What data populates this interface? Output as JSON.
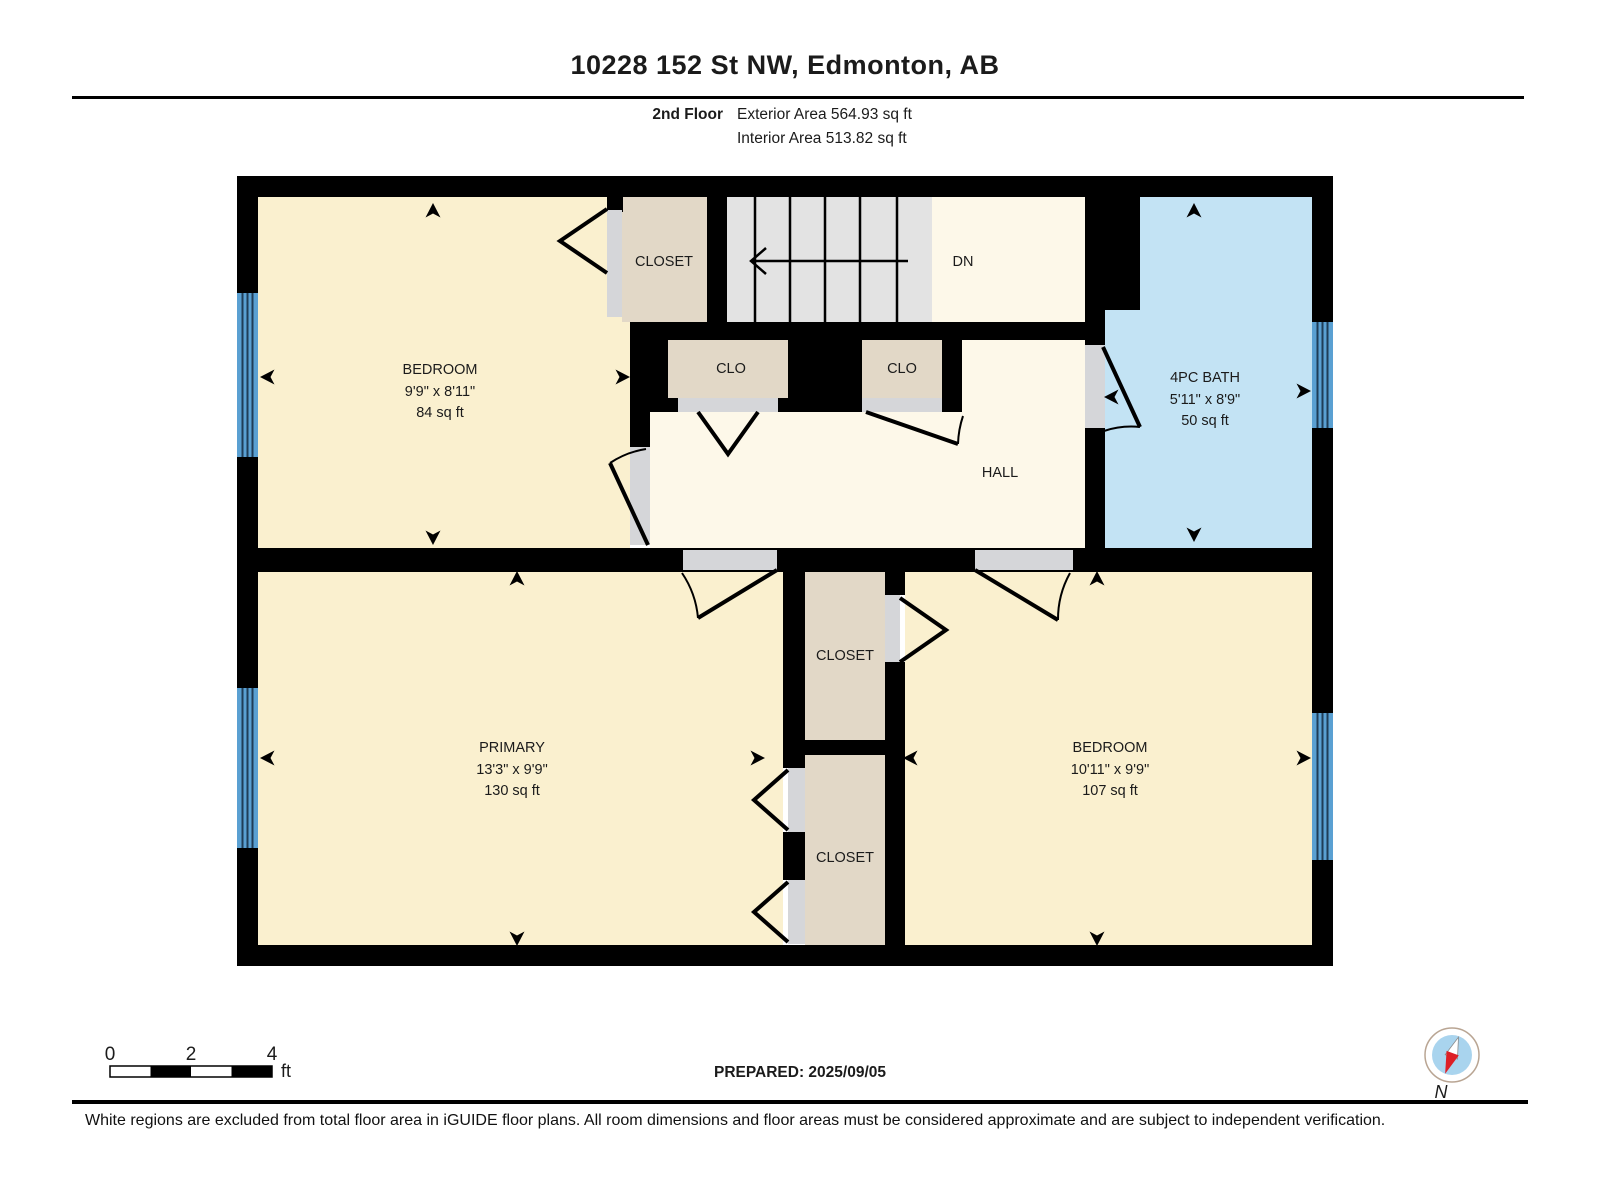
{
  "header": {
    "title": "10228 152 St NW, Edmonton, AB",
    "floor_label": "2nd Floor",
    "exterior_area": "Exterior Area 564.93 sq ft",
    "interior_area": "Interior Area 513.82 sq ft"
  },
  "rooms": {
    "bedroom_top_left": {
      "name": "BEDROOM",
      "dimensions": "9'9\" x 8'11\"",
      "area": "84 sq ft"
    },
    "closet_top": {
      "name": "CLOSET"
    },
    "stairs": {
      "direction_label": "DN"
    },
    "clo_left": {
      "name": "CLO"
    },
    "clo_right": {
      "name": "CLO"
    },
    "bath": {
      "name": "4PC BATH",
      "dimensions": "5'11\" x 8'9\"",
      "area": "50 sq ft"
    },
    "hall": {
      "name": "HALL"
    },
    "primary": {
      "name": "PRIMARY",
      "dimensions": "13'3\" x 9'9\"",
      "area": "130 sq ft"
    },
    "closet_mid": {
      "name": "CLOSET"
    },
    "closet_bottom": {
      "name": "CLOSET"
    },
    "bedroom_bottom_right": {
      "name": "BEDROOM",
      "dimensions": "10'11\" x 9'9\"",
      "area": "107 sq ft"
    }
  },
  "scale_bar": {
    "ticks": [
      "0",
      "2",
      "4"
    ],
    "unit": "ft"
  },
  "compass": {
    "label": "N"
  },
  "footer": {
    "prepared": "PREPARED: 2025/09/05",
    "disclaimer": "White regions are excluded from total floor area in iGUIDE floor plans. All room dimensions and floor areas must be considered approximate and are subject to independent verification."
  },
  "colors": {
    "room_fill": "#faf0cf",
    "hall_fill": "#fdf8e9",
    "closet_fill": "#e2d8c7",
    "bath_fill": "#c3e3f4",
    "stairs_fill": "#e3e3e3",
    "window_fill": "#5aa0d2",
    "threshold_fill": "#d5d6d9",
    "wall": "#000000",
    "compass_red": "#dd1f26",
    "compass_blue": "#a9d4ee"
  }
}
